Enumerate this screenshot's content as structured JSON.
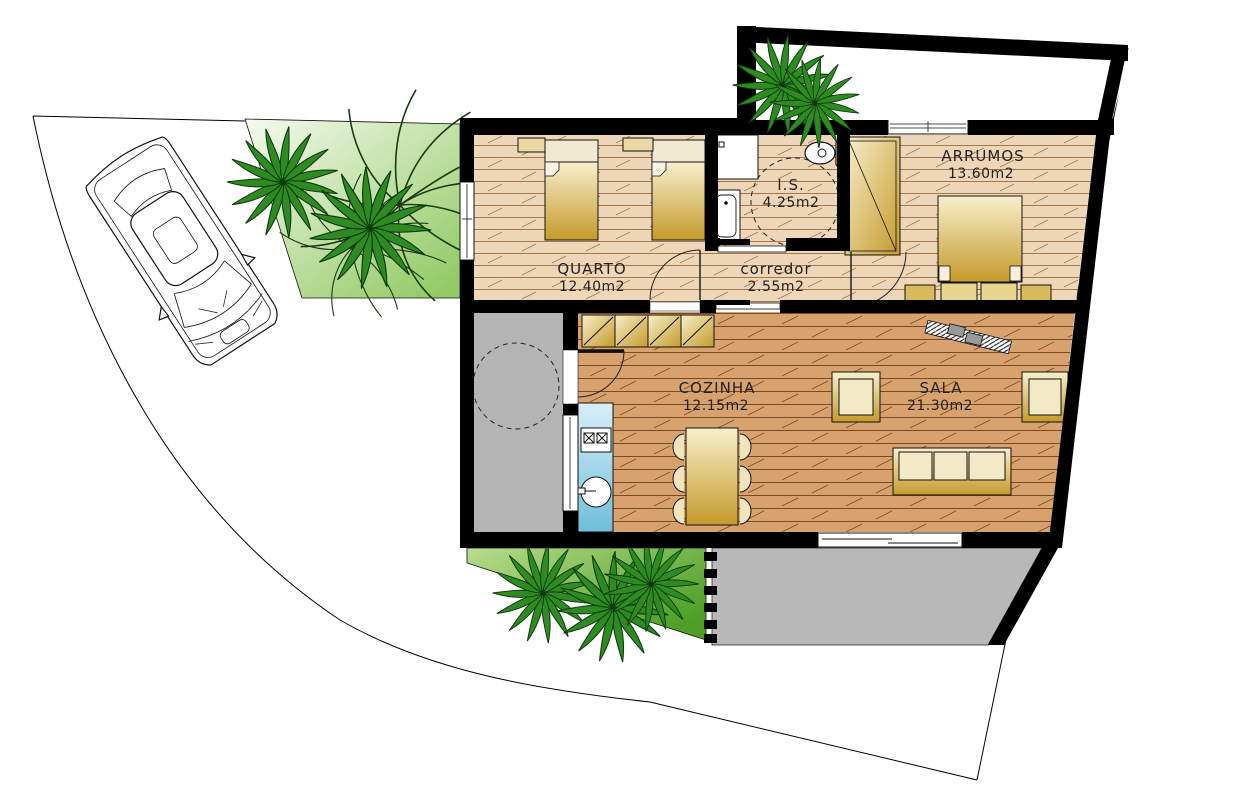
{
  "title": "Single-storey house floor plan with site, parked car and garden",
  "rooms": [
    {
      "id": "quarto",
      "name": "QUARTO",
      "area": "12.40m2"
    },
    {
      "id": "is",
      "name": "I.S.",
      "area": "4.25m2"
    },
    {
      "id": "corredor",
      "name": "corredor",
      "area": "2.55m2"
    },
    {
      "id": "arrumos",
      "name": "ARRUMOS",
      "area": "13.60m2"
    },
    {
      "id": "cozinha",
      "name": "COZINHA",
      "area": "12.15m2"
    },
    {
      "id": "sala",
      "name": "SALA",
      "area": "21.30m2"
    }
  ],
  "site": {
    "features": [
      "driveway",
      "parked-car",
      "palm-trees",
      "front-lawn",
      "walled-yard",
      "interior-patio",
      "back-lawn",
      "terrace"
    ],
    "palm_tree_count": 7
  },
  "fixtures": [
    "single-bed",
    "single-bed",
    "double-bed",
    "wardrobe",
    "shower",
    "washbasin",
    "toilet",
    "kitchen-counter",
    "stove",
    "sink",
    "upper-cabinets",
    "dining-table",
    "six-chairs",
    "sofa",
    "armchair",
    "armchair",
    "tv-shelf"
  ],
  "colors": {
    "wall": "#000000",
    "floor_bedrooms": "#eed6b8",
    "floor_living": "#d8a26e",
    "floor_lines_bedrooms": "#a5764a",
    "floor_lines_living": "#7b4a20",
    "lawn_light": "#f2f8ea",
    "lawn_green": "#55a52c",
    "patio_gray": "#b5b5b5",
    "counter_blue": "#8fcbe2",
    "furniture_gold": "#c49a2a",
    "palm_green": "#2e8b22"
  }
}
